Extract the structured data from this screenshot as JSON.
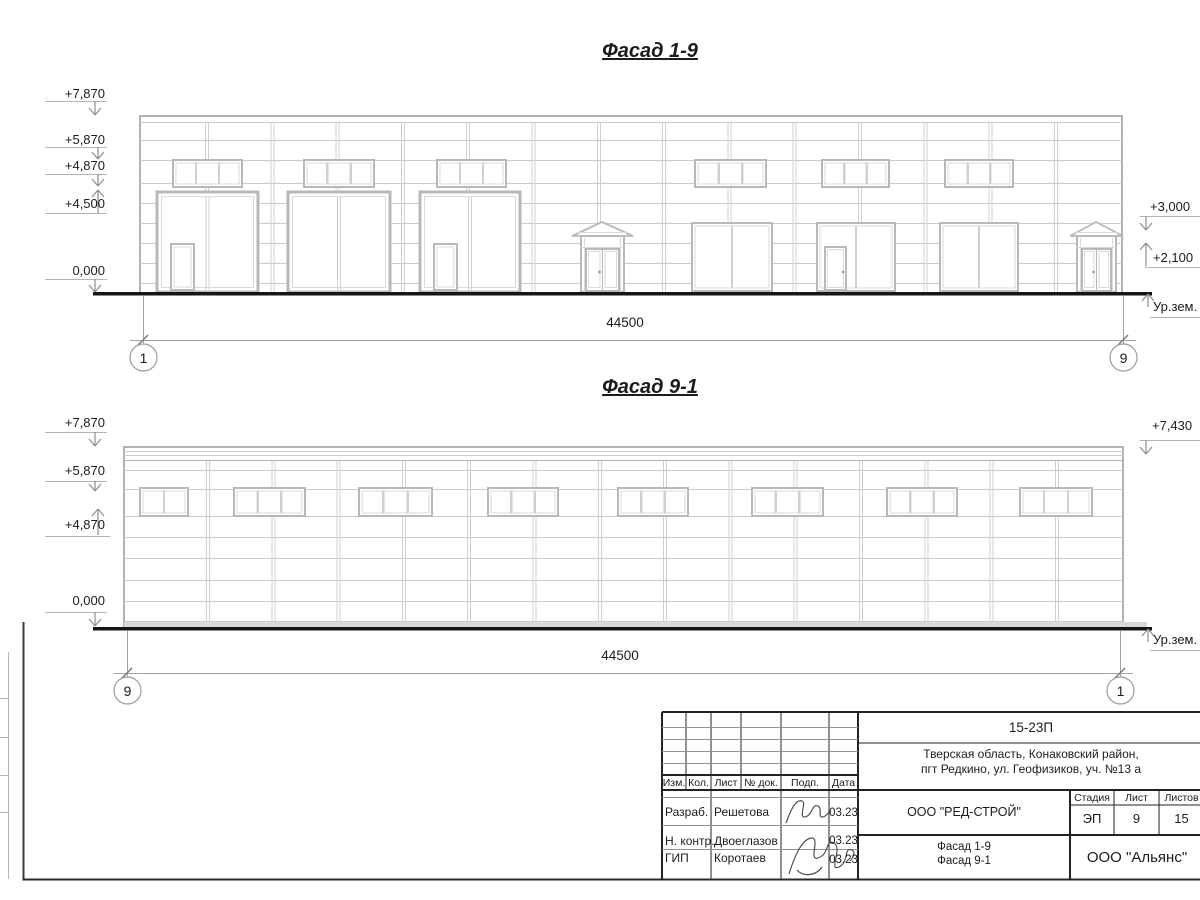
{
  "sheet": {
    "facade1": {
      "title": "Фасад 1-9",
      "marks_left": [
        "+7,870",
        "+5,870",
        "+4,870",
        "+4,500",
        "0,000"
      ],
      "marks_right": [
        "+3,000",
        "+2,100"
      ],
      "ground_label": "Ур.зем.",
      "dimension": "44500",
      "axis_left": "1",
      "axis_right": "9"
    },
    "facade2": {
      "title": "Фасад 9-1",
      "marks_left": [
        "+7,870",
        "+5,870",
        "+4,870",
        "0,000"
      ],
      "marks_right": [
        "+7,430"
      ],
      "ground_label": "Ур.зем.",
      "dimension": "44500",
      "axis_left": "9",
      "axis_right": "1"
    },
    "title_block": {
      "doc_code": "15-23П",
      "address_line1": "Тверская область, Конаковский район,",
      "address_line2": "пгт Редкино, ул. Геофизиков, уч. №13 а",
      "client_org": "ООО \"РЕД-СТРОЙ\"",
      "sheet_name_line1": "Фасад 1-9",
      "sheet_name_line2": "Фасад 9-1",
      "contractor_org": "ООО \"Альянс\"",
      "col_izm": "Изм.",
      "col_kol": "Кол.",
      "col_list": "Лист",
      "col_doc": "№ док.",
      "col_podp": "Подп.",
      "col_data": "Дата",
      "stage_label": "Стадия",
      "sheet_label": "Лист",
      "sheets_label": "Листов",
      "stage_value": "ЭП",
      "sheet_value": "9",
      "sheets_value": "15",
      "rows": [
        {
          "role": "Разраб.",
          "name": "Решетова",
          "date": "03.23"
        },
        {
          "role": "Н. контр.",
          "name": "Двоеглазов",
          "date": "03.23"
        },
        {
          "role": "ГИП",
          "name": "Коротаев",
          "date": "03.23"
        }
      ]
    }
  }
}
